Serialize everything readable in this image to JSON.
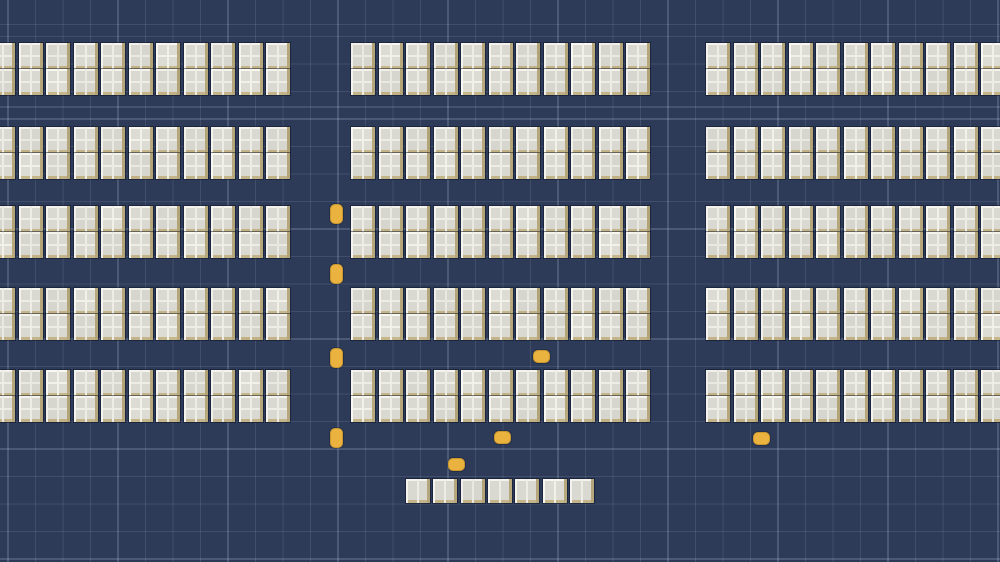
{
  "meta": {
    "description": "Top-down blueprint-style game map: rows of white window-like building tiles on a navy grid with small yellow vehicles",
    "canvas": {
      "width": 1000,
      "height": 562
    }
  },
  "palette": {
    "background": "#2d3b58",
    "grid_minor": "rgba(195,210,232,0.13)",
    "grid_major": "rgba(200,214,235,0.30)",
    "tile_pane": "#d9d8d1",
    "tile_frame_light": "#f4f3ed",
    "tile_frame_mid": "#eeede5",
    "tile_frame_tan": "#b5a67c",
    "tile_frame_tan_bottom": "#c3b489",
    "tile_outline": "rgba(10,18,35,0.5)",
    "vehicle": "#eab340",
    "vehicle_edge": "rgba(150,100,15,0.35)"
  },
  "grid": {
    "cell": 27.5,
    "major_spacing": 110,
    "offset_x": 7.5,
    "offset_y": 25
  },
  "layout": {
    "tile": {
      "width": 24,
      "height": 26,
      "pitch": 27.5
    },
    "rows_per_band": 2,
    "band_ys": [
      43,
      127,
      206,
      288,
      370
    ],
    "columns": [
      {
        "id": "left",
        "x": -9,
        "tiles_per_row": 11
      },
      {
        "id": "center",
        "x": 351,
        "tiles_per_row": 11
      },
      {
        "id": "right",
        "x": 706,
        "tiles_per_row": 11
      }
    ],
    "bottom_row": {
      "x": 406,
      "y": 479,
      "count": 7,
      "tile_width": 24,
      "tile_height": 24,
      "pitch": 27.3
    }
  },
  "vehicle_size": {
    "vertical": {
      "w": 13,
      "h": 20
    },
    "horizontal": {
      "w": 17,
      "h": 13
    }
  },
  "vehicles": [
    {
      "x": 330,
      "y": 204,
      "orientation": "vertical"
    },
    {
      "x": 330,
      "y": 264,
      "orientation": "vertical"
    },
    {
      "x": 330,
      "y": 348,
      "orientation": "vertical"
    },
    {
      "x": 330,
      "y": 428,
      "orientation": "vertical"
    },
    {
      "x": 533,
      "y": 350,
      "orientation": "horizontal"
    },
    {
      "x": 494,
      "y": 431,
      "orientation": "horizontal"
    },
    {
      "x": 448,
      "y": 458,
      "orientation": "horizontal"
    },
    {
      "x": 753,
      "y": 432,
      "orientation": "horizontal"
    }
  ],
  "counts": {
    "building_tiles": 337,
    "vehicles": 8
  }
}
